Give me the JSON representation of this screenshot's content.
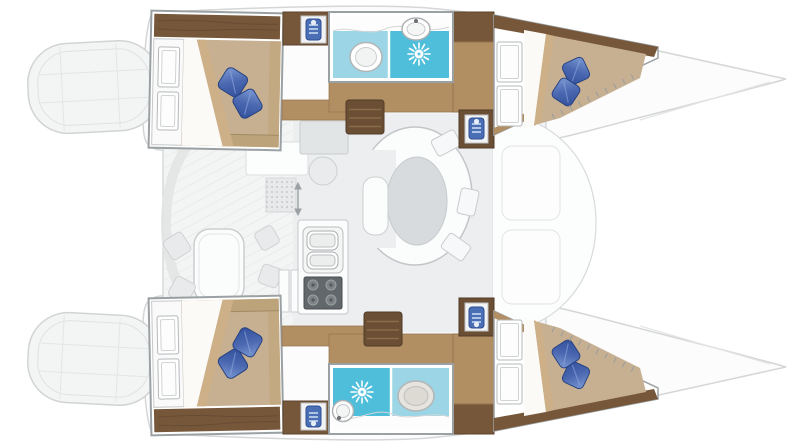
{
  "page": {
    "title": "Catamaran interior layout floor plan",
    "background": "#ffffff"
  },
  "palette": {
    "hull_outline": "#d5d7d7",
    "deck_white": "#fcfcfd",
    "bridge_floor": "#f2f4f5",
    "salon_floor": "#eceef0",
    "cockpit_floor": "#f3f4f4",
    "wood_dark": "#76573a",
    "wood_mid": "#b28e63",
    "wood_light": "#bfa379",
    "mattress_tan": "#c7b092",
    "sheet_white": "#fbfaf6",
    "sheet_fold": "#cdb088",
    "pillow_blue_dark": "#35509a",
    "pillow_blue_light": "#7e9bd6",
    "bathroom_cyan": "#9cd6e6",
    "shower_cyan": "#4fbeda",
    "fixture_white": "#ffffff",
    "frame_gray": "#9ba1a3",
    "table_gray": "#d8dbdd",
    "stove_gray": "#62676b",
    "cushion_gray": "#e8eaeb"
  },
  "layout": {
    "vessel_type": "catamaran",
    "view": "top-down",
    "hull_count": 2,
    "cabins": [
      {
        "id": "top-aft-cabin",
        "fixtures": [
          "double-bed",
          "two-blue-pillows",
          "folded-sheet",
          "shelf-unit",
          "wardrobe"
        ]
      },
      {
        "id": "top-forward-cabin",
        "fixtures": [
          "double-bed",
          "two-blue-pillows",
          "folded-sheet",
          "shelf-unit"
        ]
      },
      {
        "id": "bottom-aft-cabin",
        "fixtures": [
          "double-bed",
          "two-blue-pillows",
          "folded-sheet",
          "shelf-unit",
          "wardrobe"
        ]
      },
      {
        "id": "bottom-forward-cabin",
        "fixtures": [
          "double-bed",
          "two-blue-pillows",
          "folded-sheet",
          "shelf-unit"
        ]
      }
    ],
    "bathrooms": [
      {
        "id": "top-head",
        "fixtures": [
          "toilet",
          "vanity-sink",
          "shower-drain",
          "counter"
        ]
      },
      {
        "id": "bottom-head",
        "fixtures": [
          "toilet",
          "vanity-sink",
          "shower-drain",
          "counter"
        ]
      }
    ],
    "salon": {
      "fixtures": [
        "curved-settee",
        "oval-table",
        "seat-cushions",
        "nav-table",
        "stool",
        "entry-mat",
        "sliding-door-arrow"
      ]
    },
    "galley": {
      "fixtures": [
        "double-sink",
        "four-burner-stove",
        "counters"
      ]
    },
    "cockpit": {
      "fixtures": [
        "cockpit-table",
        "scatter-cushions",
        "curved-bench"
      ]
    },
    "deck": {
      "fixtures": [
        "transom-steps",
        "pointed-bows",
        "foredeck-hatches",
        "companionway-steps",
        "towel-lockers"
      ]
    }
  }
}
